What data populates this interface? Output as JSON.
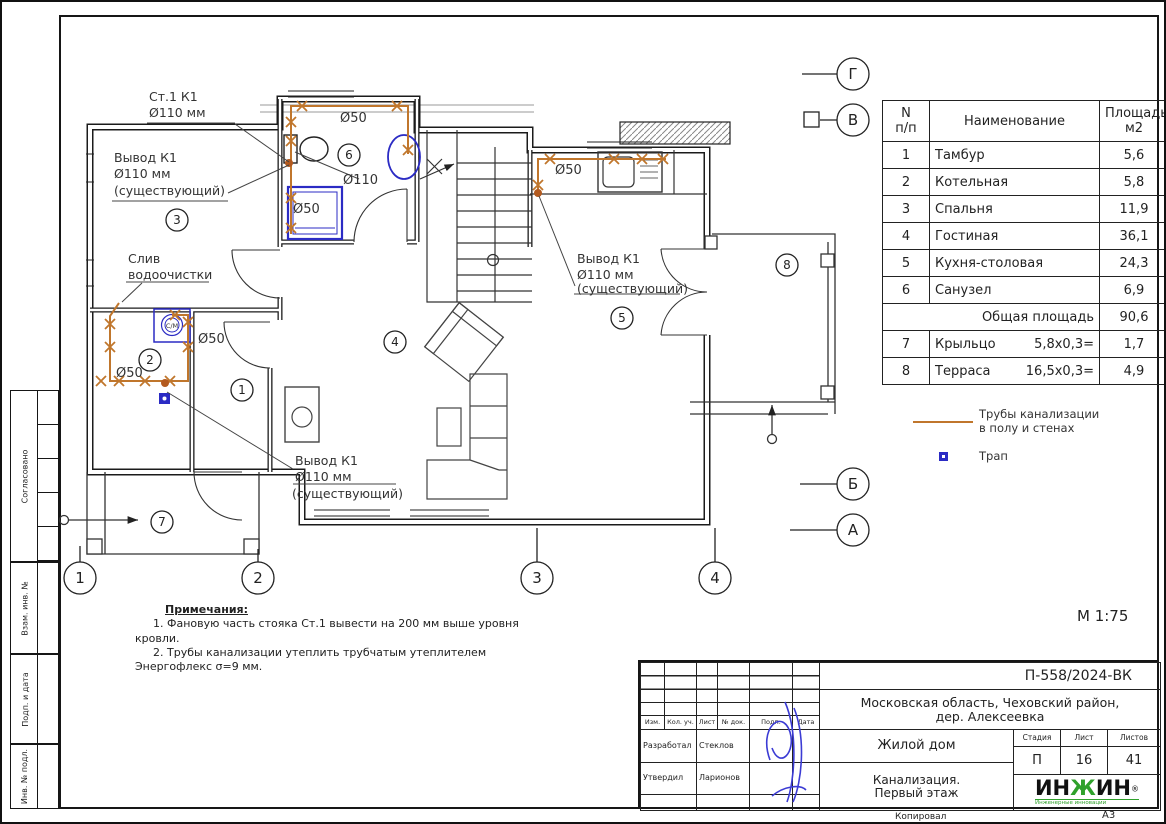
{
  "sheet": {
    "scale": "М 1:75",
    "footer": {
      "kopiroval": "Копировал",
      "format": "А3"
    }
  },
  "side_stamps": {
    "soglasovano": "Согласовано",
    "vzam": "Взам. инв. №",
    "podp": "Подп. и дата",
    "inv": "Инв. № подл."
  },
  "plan": {
    "axis": {
      "g": "Г",
      "v": "В",
      "b": "Б",
      "a": "А",
      "c1": "1",
      "c2": "2",
      "c3": "3",
      "c4": "4"
    },
    "rooms": {
      "r1": "1",
      "r2": "2",
      "r3": "3",
      "r4": "4",
      "r5": "5",
      "r6": "6",
      "r7": "7",
      "r8": "8"
    },
    "labels": {
      "stack1": "Ст.1 К1",
      "stack2": "Ø110 мм",
      "vyvod1": "Вывод К1",
      "vyvod2": "Ø110 мм",
      "vyvod3": "(существующий)",
      "sliv1": "Слив",
      "sliv2": "водоочистки",
      "d50": "Ø50",
      "d110": "Ø110",
      "sm": "С/М"
    }
  },
  "table": {
    "headers": {
      "n1": "N",
      "n2": "п/п",
      "name": "Наименование",
      "area1": "Площадь",
      "area2": "м2"
    },
    "rows": [
      {
        "n": "1",
        "name": "Тамбур",
        "area": "5,6"
      },
      {
        "n": "2",
        "name": "Котельная",
        "area": "5,8"
      },
      {
        "n": "3",
        "name": "Спальня",
        "area": "11,9"
      },
      {
        "n": "4",
        "name": "Гостиная",
        "area": "36,1"
      },
      {
        "n": "5",
        "name": "Кухня-столовая",
        "area": "24,3"
      },
      {
        "n": "6",
        "name": "Санузел",
        "area": "6,9"
      }
    ],
    "total": {
      "label": "Общая площадь",
      "area": "90,6"
    },
    "extra": [
      {
        "n": "7",
        "name": "Крыльцо",
        "calc": "5,8х0,3=",
        "area": "1,7"
      },
      {
        "n": "8",
        "name": "Терраса",
        "calc": "16,5х0,3=",
        "area": "4,9"
      }
    ]
  },
  "legend": {
    "pipes1": "Трубы канализации",
    "pipes2": "в полу и стенах",
    "trap": "Трап"
  },
  "notes": {
    "title": "Примечания:",
    "line1": "1.   Фановую часть стояка Ст.1   вывести на 200 мм выше уровня",
    "line2": "кровли.",
    "line3": "2.   Трубы канализации утеплить трубчатым утеплителем",
    "line4": "Энергофлекс σ=9 мм."
  },
  "titleblock": {
    "code": "П-558/2024-ВК",
    "location1": "Московская область, Чеховский район,",
    "location2": "дер. Алексеевка",
    "object": "Жилой дом",
    "doc1": "Канализация.",
    "doc2": "Первый этаж",
    "cols": {
      "izm": "Изм.",
      "kol": "Кол. уч.",
      "list": "Лист",
      "ndok": "№ док.",
      "podp": "Подп.",
      "data": "Дата"
    },
    "roles": {
      "razrabotal": "Разработал",
      "razrabotal_name": "Стеклов",
      "utverdil": "Утвердил",
      "utverdil_name": "Ларионов"
    },
    "stage": {
      "label": "Стадия",
      "value": "П"
    },
    "sheet": {
      "label": "Лист",
      "value": "16"
    },
    "sheets": {
      "label": "Листов",
      "value": "41"
    },
    "logo": {
      "p1": "ИН",
      "p2": "Ж",
      "p3": "ИН",
      "reg": "®",
      "sub": "Инженерные инновации"
    }
  },
  "colors": {
    "pipe": "#c0762c",
    "fixture": "#2b2bc4",
    "logo_green": "#2fa12b"
  }
}
